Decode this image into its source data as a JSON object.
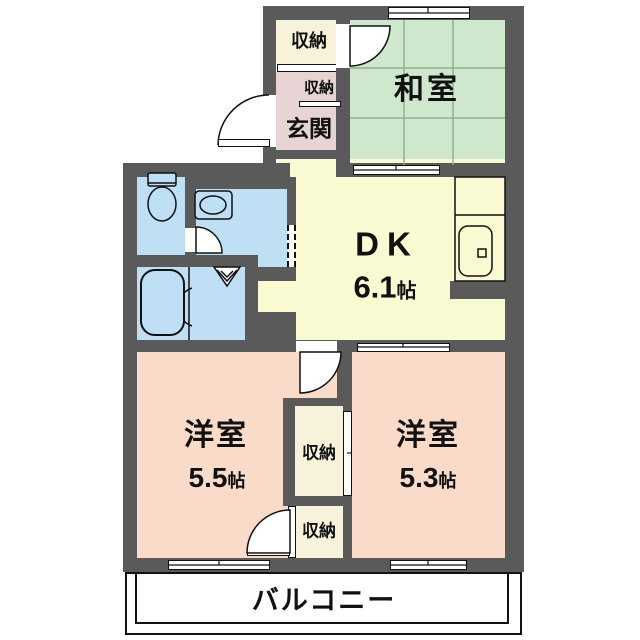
{
  "floorplan": {
    "balcony": {
      "label": "バルコニー"
    },
    "rooms": {
      "washitsu": {
        "label": "和室"
      },
      "dk": {
        "label": "DK",
        "size_value": "6.1",
        "size_unit": "帖"
      },
      "genkan": {
        "label": "玄関"
      },
      "bedroom_left": {
        "label": "洋室",
        "size_value": "5.5",
        "size_unit": "帖"
      },
      "bedroom_right": {
        "label": "洋室",
        "size_value": "5.3",
        "size_unit": "帖"
      }
    },
    "storages": {
      "entry_top": {
        "label": "収納"
      },
      "entry_inner": {
        "label": "収納"
      },
      "closet_upper": {
        "label": "収納"
      },
      "closet_lower": {
        "label": "収納"
      }
    },
    "fixtures": {
      "toilet": "toilet",
      "washbasin": "washbasin",
      "bathtub": "bathtub",
      "kitchen_sink": "kitchen-sink",
      "laundry_space": "laundry-triangle-symbol"
    },
    "palette": {
      "wall": "#5a5a5a",
      "tatami_green": "#cfe8cd",
      "dk_yellow": "#f9f9d2",
      "bedroom_peach": "#fadbca",
      "sanitary_blue": "#bedff4",
      "storage_cream": "#f7f3da",
      "genkan_pink": "#e7d3d3",
      "line_black": "#111111"
    }
  }
}
